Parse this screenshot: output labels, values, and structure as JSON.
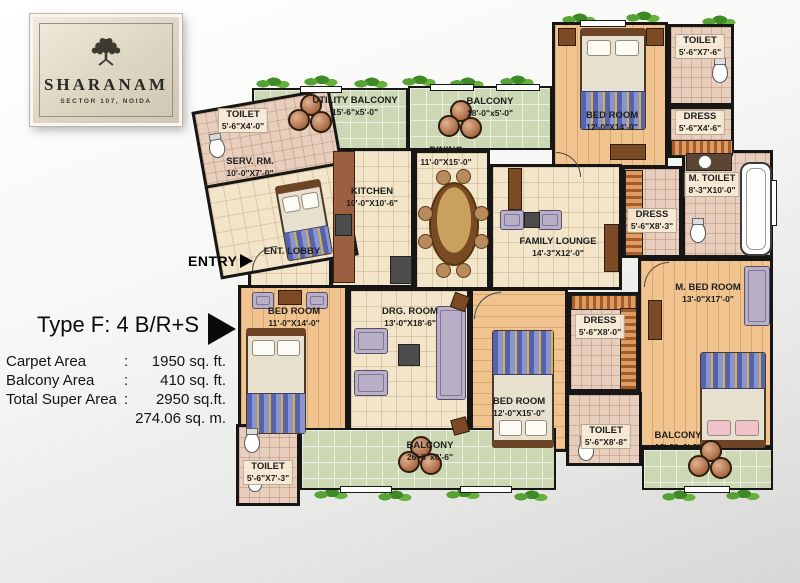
{
  "logo": {
    "title": "SHARANAM",
    "subtitle": "SECTOR 107, NOIDA"
  },
  "info": {
    "type_label": "Type F: 4 B/R+S",
    "rows": [
      {
        "label": "Carpet Area",
        "colon": ":",
        "value": "1950 sq. ft."
      },
      {
        "label": "Balcony Area",
        "colon": ":",
        "value": "410 sq. ft."
      },
      {
        "label": "Total Super Area",
        "colon": ":",
        "value": "2950 sq.ft."
      },
      {
        "label": "",
        "colon": "",
        "value": "274.06 sq. m."
      }
    ]
  },
  "entry": {
    "label": "ENTRY"
  },
  "rooms": {
    "toilet_tl": {
      "name": "TOILET",
      "dims": "5'-6\"X4'-0\""
    },
    "serv_rm": {
      "name": "SERV. RM.",
      "dims": "10'-0\"X7'-0\""
    },
    "utility_balcony": {
      "name": "UTILITY BALCONY",
      "dims": "15'-6\"x5'-0\""
    },
    "kitchen": {
      "name": "KITCHEN",
      "dims": "10'-0\"X10'-6\""
    },
    "balcony_top": {
      "name": "BALCONY",
      "dims": "18'-0\"x5'-0\""
    },
    "dining": {
      "name": "DINING",
      "dims": "11'-0\"X15'-0\""
    },
    "family_lounge": {
      "name": "FAMILY LOUNGE",
      "dims": "14'-3\"X12'-0\""
    },
    "ent_lobby": {
      "name": "ENT. LOBBY",
      "dims": ""
    },
    "bedroom_tr": {
      "name": "BED ROOM",
      "dims": "12'-0\"X14'-0\""
    },
    "toilet_tr": {
      "name": "TOILET",
      "dims": "5'-6\"X7'-6\""
    },
    "dress_tr": {
      "name": "DRESS",
      "dims": "5'-6\"X4'-6\""
    },
    "m_toilet": {
      "name": "M. TOILET",
      "dims": "8'-3\"X10'-0\""
    },
    "dress_m": {
      "name": "DRESS",
      "dims": "5'-6\"X8'-3\""
    },
    "m_bed_room": {
      "name": "M. BED ROOM",
      "dims": "13'-0\"X17'-0\""
    },
    "dress_mid": {
      "name": "DRESS",
      "dims": "5'-6\"X8'-0\""
    },
    "bedroom_left": {
      "name": "BED ROOM",
      "dims": "11'-0\"X14'-0\""
    },
    "drg_room": {
      "name": "DRG. ROOM",
      "dims": "13'-0\"X18'-6\""
    },
    "bedroom_mid": {
      "name": "BED ROOM",
      "dims": "12'-0\"X15'-0\""
    },
    "toilet_bl": {
      "name": "TOILET",
      "dims": "5'-6\"X7'-3\""
    },
    "balcony_bottom": {
      "name": "BALCONY",
      "dims": "26'-8\"x6'-6\""
    },
    "toilet_bm": {
      "name": "TOILET",
      "dims": "5'-6\"X8'-8\""
    },
    "balcony_br": {
      "name": "BALCONY",
      "dims": "13'-9\"x6'-6\""
    }
  },
  "colors": {
    "wall": "#161616",
    "floor_tile": "#f2e5c9",
    "balcony_tile": "#ccd7b4",
    "wood_floor": "#f0c38f",
    "toilet_tile": "#e8cfbd",
    "logo_plaque": "#ddd5c2"
  }
}
